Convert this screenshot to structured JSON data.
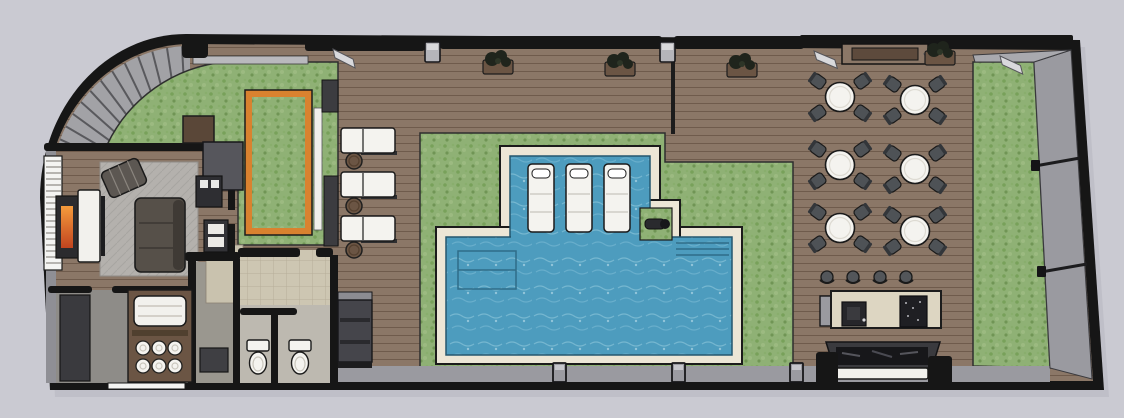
{
  "meta": {
    "title": "Rooftop Amenity Terrace - 3D Floor Plan Rendering",
    "canvas_width": 1124,
    "canvas_height": 418,
    "view": "top-down axonometric floor plan, no text labels"
  },
  "palette": {
    "background": "#cacad2",
    "shadow": "#b6b6bf",
    "wall": "#161616",
    "deck": "#8b7767",
    "deck_line": "#5f4f41",
    "turf": "#8fb175",
    "turf_dark": "#76a058",
    "water": "#4d9cbe",
    "water_light": "#a8d8e8",
    "coping": "#ece6d6",
    "planter_orange": "#d9822f",
    "stripe_band": "#a2a2a6",
    "stripe_line": "#59595d",
    "parapet": "#9a9aa0",
    "tile": "#cdc6b2",
    "rug": "#b4b1ad",
    "chair": "#4e5256",
    "furniture_white": "#f4f3ef",
    "cabinet_dark": "#3a3a3e",
    "bar_counter": "#ddd6c2",
    "fire_top": "#f59b3c",
    "fire_bottom": "#c1441f",
    "wood_box": "#6b5544"
  },
  "legend": {
    "spaces": [
      {
        "name": "curved-louver-roof-edge"
      },
      {
        "name": "indoor-lounge"
      },
      {
        "name": "towel-storage-room"
      },
      {
        "name": "restrooms-two-stalls"
      },
      {
        "name": "turf-garden-northwest"
      },
      {
        "name": "framed-turf-planter"
      },
      {
        "name": "sun-lounger-deck"
      },
      {
        "name": "pool-with-tanning-ledge"
      },
      {
        "name": "pool-lap-section"
      },
      {
        "name": "corner-spout-planter"
      },
      {
        "name": "turf-surround"
      },
      {
        "name": "dining-terrace-six-tables"
      },
      {
        "name": "outdoor-bar"
      },
      {
        "name": "fire-planter-bench"
      },
      {
        "name": "turf-strip-east"
      },
      {
        "name": "parapet-walls"
      }
    ]
  },
  "furniture": {
    "dining_sets": [
      {
        "cx": 840,
        "cy": 97
      },
      {
        "cx": 915,
        "cy": 100
      },
      {
        "cx": 840,
        "cy": 165
      },
      {
        "cx": 915,
        "cy": 169
      },
      {
        "cx": 840,
        "cy": 228
      },
      {
        "cx": 915,
        "cy": 231
      }
    ],
    "chair_offsets": [
      [
        -21,
        -15
      ],
      [
        21,
        -15
      ],
      [
        -21,
        15
      ],
      [
        21,
        15
      ]
    ],
    "deck_loungers": [
      {
        "x": 341,
        "y": 128
      },
      {
        "x": 341,
        "y": 172
      },
      {
        "x": 341,
        "y": 216
      }
    ],
    "deck_side_tables": [
      {
        "cx": 354,
        "cy": 161
      },
      {
        "cx": 354,
        "cy": 206
      },
      {
        "cx": 354,
        "cy": 250
      }
    ],
    "pool_loungers": [
      {
        "x": 528
      },
      {
        "x": 566
      },
      {
        "x": 604
      }
    ],
    "pool_lounger_y": 164,
    "bar_stools": [
      827,
      853,
      880,
      906
    ],
    "bar_stool_y": 277,
    "wall_planters": [
      {
        "cx": 498,
        "cy": 63
      },
      {
        "cx": 620,
        "cy": 65
      },
      {
        "cx": 742,
        "cy": 66
      },
      {
        "cx": 940,
        "cy": 54
      }
    ],
    "wall_lights": [
      {
        "x": 333,
        "y": 49,
        "rot": 14
      },
      {
        "x": 814,
        "y": 51,
        "rot": 10
      },
      {
        "x": 924,
        "y": 54,
        "rot": -8
      },
      {
        "x": 1000,
        "y": 56,
        "rot": 12
      }
    ],
    "top_wall_posts": [
      425,
      660
    ],
    "parapet_posts": [
      553,
      672,
      790
    ],
    "rolled_towels": [
      {
        "cx": 143,
        "cy": 348
      },
      {
        "cx": 159,
        "cy": 348
      },
      {
        "cx": 175,
        "cy": 348
      },
      {
        "cx": 143,
        "cy": 366
      },
      {
        "cx": 159,
        "cy": 366
      },
      {
        "cx": 175,
        "cy": 366
      }
    ],
    "toilets": [
      {
        "x": 247,
        "y": 340
      },
      {
        "x": 289,
        "y": 340
      }
    ]
  },
  "decor": {
    "stripe_band": {
      "cx": 190,
      "cy": 199,
      "r1": 98,
      "r2": 157,
      "start_deg": 93,
      "end_deg": 178,
      "count": 15
    },
    "stair_ticks": {
      "x1": 46,
      "x2": 61,
      "y": 161,
      "gap": 6,
      "count": 18
    },
    "parapet_dividers": [
      {
        "x1": 1035,
        "y1": 166,
        "x2": 1080,
        "y2": 158
      },
      {
        "x1": 1041,
        "y1": 272,
        "x2": 1087,
        "y2": 264
      }
    ]
  }
}
